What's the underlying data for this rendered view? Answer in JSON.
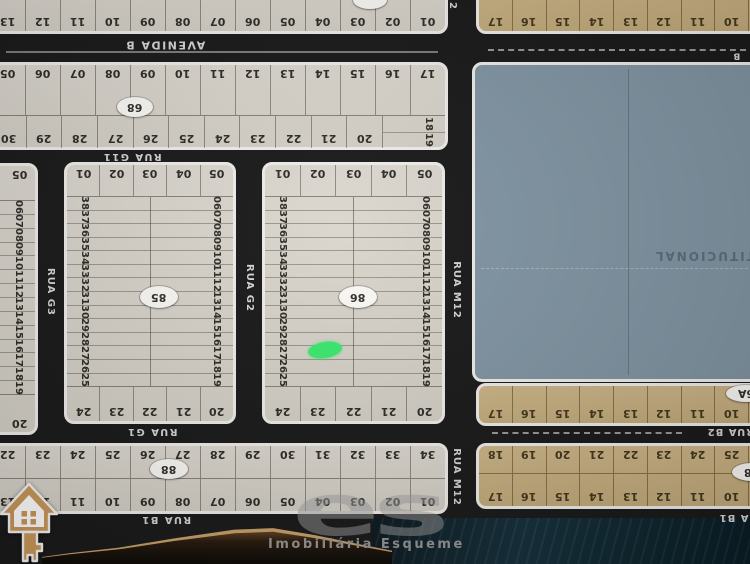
{
  "colors": {
    "street_bg": "#1a1a1a",
    "block_light": "#d8d4cb",
    "block_tan": "#c8b082",
    "area_blue": "#8296a4",
    "border_white": "#efeeea",
    "marker_green": "#3ce96f",
    "icon_gold": "#c9975a",
    "watermark_grey": "#959595"
  },
  "streets": {
    "avenida_b": {
      "label": "AVENIDA B",
      "fragment": "B"
    },
    "rua_g11": {
      "label": "RUA G11"
    },
    "rua_g3": {
      "label": "RUA G3"
    },
    "rua_g2": {
      "label": "RUA G2"
    },
    "rua_g1": {
      "label": "RUA G1"
    },
    "rua_m12": {
      "label": "RUA M12",
      "top_fragment": "2"
    },
    "rua_b2": {
      "label": "RUA B2"
    },
    "rua_b1": {
      "label": "RUA B1"
    }
  },
  "blocks": {
    "strip_top_left": {
      "lots": [
        "13",
        "12",
        "11",
        "10",
        "09",
        "08",
        "07",
        "06",
        "05",
        "04",
        "03",
        "02",
        "01"
      ]
    },
    "strip_top_right": {
      "lots": [
        "17",
        "16",
        "15",
        "14",
        "13",
        "12",
        "11",
        "10"
      ]
    },
    "quadra_68": {
      "label": "68",
      "row_top": [
        "05",
        "06",
        "07",
        "08",
        "09",
        "10",
        "11",
        "12",
        "13",
        "14",
        "15",
        "16",
        "17"
      ],
      "side": [
        "18",
        "19"
      ],
      "row_bottom": [
        "30",
        "29",
        "28",
        "27",
        "26",
        "25",
        "24",
        "23",
        "22",
        "21",
        "20"
      ]
    },
    "partial_left": {
      "corner_top": "05",
      "column": [
        "06",
        "07",
        "08",
        "09",
        "10",
        "11",
        "12",
        "13",
        "14",
        "15",
        "16",
        "17",
        "18",
        "19"
      ],
      "corner_bottom": "20"
    },
    "quadra_85": {
      "label": "85",
      "row_top": [
        "01",
        "02",
        "03",
        "04",
        "05"
      ],
      "col_left": [
        "38",
        "37",
        "36",
        "35",
        "34",
        "33",
        "32",
        "31",
        "30",
        "29",
        "28",
        "27",
        "26",
        "25"
      ],
      "col_right": [
        "06",
        "07",
        "08",
        "09",
        "10",
        "11",
        "12",
        "13",
        "14",
        "15",
        "16",
        "17",
        "18",
        "19"
      ],
      "row_bottom": [
        "24",
        "23",
        "22",
        "21",
        "20"
      ]
    },
    "quadra_86": {
      "label": "86",
      "row_top": [
        "01",
        "02",
        "03",
        "04",
        "05"
      ],
      "col_left": [
        "38",
        "37",
        "36",
        "35",
        "34",
        "33",
        "32",
        "31",
        "30",
        "29",
        "28",
        "27",
        "26",
        "25"
      ],
      "col_right": [
        "06",
        "07",
        "08",
        "09",
        "10",
        "11",
        "12",
        "13",
        "14",
        "15",
        "16",
        "17",
        "18",
        "19"
      ],
      "row_bottom": [
        "24",
        "23",
        "22",
        "21",
        "20"
      ],
      "marker": {
        "color": "#3ce96f",
        "lot": "27"
      }
    },
    "area_institucional": {
      "label": "INSTITUCIONAL"
    },
    "strip_6a": {
      "label": "6A",
      "lots": [
        "17",
        "16",
        "15",
        "14",
        "13",
        "12",
        "11",
        "10"
      ]
    },
    "quadra_88": {
      "label": "88",
      "row_top": [
        "22",
        "23",
        "24",
        "25",
        "26",
        "27",
        "28",
        "29",
        "30",
        "31",
        "32",
        "33",
        "34"
      ],
      "row_bottom": [
        "13",
        "12",
        "11",
        "10",
        "09",
        "08",
        "07",
        "06",
        "05",
        "04",
        "03",
        "02",
        "01"
      ]
    },
    "quadra_68b": {
      "label": "68",
      "row_top": [
        "18",
        "19",
        "20",
        "21",
        "22",
        "23",
        "24",
        "25"
      ],
      "row_bottom": [
        "17",
        "16",
        "15",
        "14",
        "13",
        "12",
        "11",
        "10"
      ]
    }
  },
  "watermark": {
    "text": "Imobiliária Esqueme",
    "logo": "es"
  }
}
